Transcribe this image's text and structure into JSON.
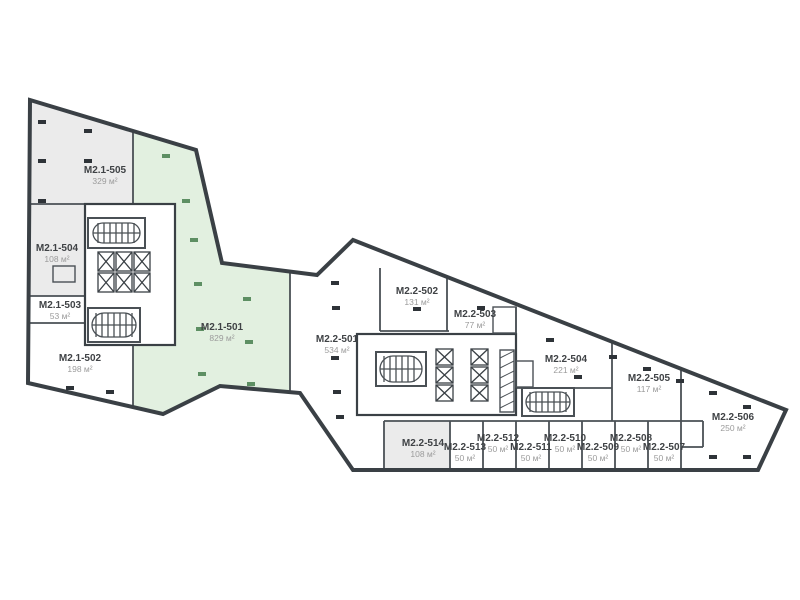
{
  "page": {
    "background": "#ffffff"
  },
  "colors": {
    "wall": "#3a4045",
    "wall_thin": "#4a5055",
    "room_white": "#ffffff",
    "room_gray": "#ebebeb",
    "room_green": "#e2f0e0",
    "column_black": "#2e3338",
    "column_green": "#5d8f63",
    "label_text": "#3f4245",
    "area_text": "#9b9b9b"
  },
  "floorplan": {
    "unit_suffix": "м²",
    "rooms": [
      {
        "id": "M2.1-505",
        "area": "329 м²",
        "x": 105,
        "y": 173,
        "zone": "gray"
      },
      {
        "id": "M2.1-504",
        "area": "108 м²",
        "x": 57,
        "y": 251,
        "zone": "gray"
      },
      {
        "id": "M2.1-503",
        "area": "53 м²",
        "x": 60,
        "y": 308,
        "zone": "white"
      },
      {
        "id": "M2.1-502",
        "area": "198 м²",
        "x": 80,
        "y": 361,
        "zone": "white"
      },
      {
        "id": "M2.1-501",
        "area": "829 м²",
        "x": 222,
        "y": 330,
        "zone": "green"
      },
      {
        "id": "M2.2-501",
        "area": "534 м²",
        "x": 337,
        "y": 342,
        "zone": "white"
      },
      {
        "id": "M2.2-502",
        "area": "131 м²",
        "x": 417,
        "y": 294,
        "zone": "white"
      },
      {
        "id": "M2.2-503",
        "area": "77 м²",
        "x": 475,
        "y": 317,
        "zone": "white"
      },
      {
        "id": "M2.2-504",
        "area": "221 м²",
        "x": 566,
        "y": 362,
        "zone": "white"
      },
      {
        "id": "M2.2-505",
        "area": "117 м²",
        "x": 649,
        "y": 381,
        "zone": "white"
      },
      {
        "id": "M2.2-506",
        "area": "250 м²",
        "x": 733,
        "y": 420,
        "zone": "white"
      },
      {
        "id": "M2.2-507",
        "area": "50 м²",
        "x": 664,
        "y": 450,
        "zone": "white"
      },
      {
        "id": "M2.2-508",
        "area": "50 м²",
        "x": 631,
        "y": 441,
        "zone": "white"
      },
      {
        "id": "M2.2-509",
        "area": "50 м²",
        "x": 598,
        "y": 450,
        "zone": "white"
      },
      {
        "id": "M2.2-510",
        "area": "50 м²",
        "x": 565,
        "y": 441,
        "zone": "white"
      },
      {
        "id": "M2.2-511",
        "area": "50 м²",
        "x": 531,
        "y": 450,
        "zone": "white"
      },
      {
        "id": "M2.2-512",
        "area": "50 м²",
        "x": 498,
        "y": 441,
        "zone": "white"
      },
      {
        "id": "M2.2-513",
        "area": "50 м²",
        "x": 465,
        "y": 450,
        "zone": "white"
      },
      {
        "id": "M2.2-514",
        "area": "108 м²",
        "x": 423,
        "y": 446,
        "zone": "gray"
      }
    ]
  }
}
